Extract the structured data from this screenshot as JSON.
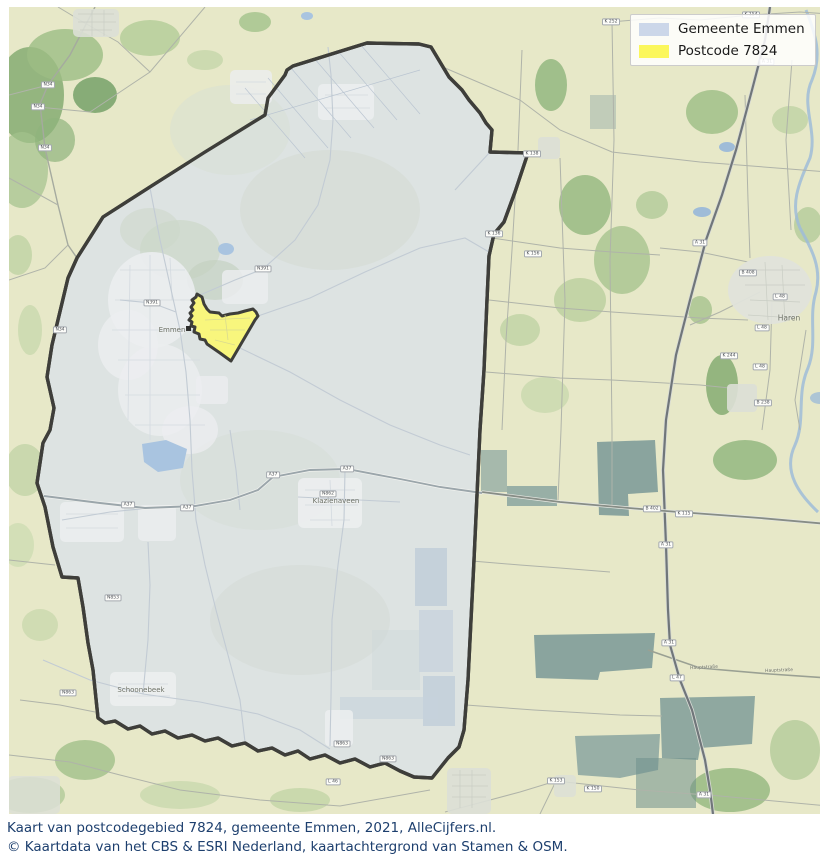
{
  "legend": {
    "items": [
      {
        "label": "Gemeente Emmen",
        "swatch_color": "#ccd7e9"
      },
      {
        "label": "Postcode 7824",
        "swatch_color": "#fbf75c"
      }
    ]
  },
  "caption": {
    "lines": [
      "Kaart van postcodegebied 7824, gemeente Emmen, 2021, AlleCijfers.nl.",
      "© Kaartdata van het CBS & ESRI Nederland, kaartachtergrond van Stamen & OSM."
    ],
    "text_color": "#1d3f6e"
  },
  "map": {
    "region_name": "Gemeente Emmen",
    "highlight_name": "Postcode 7824",
    "colors": {
      "municipality_fill": "#dde3e2",
      "municipality_border": "#3e3e3a",
      "highlight_fill": "#f8f67d",
      "background_land": "#e7e8c8",
      "water": "#a9c4e0"
    },
    "town_labels": [
      {
        "text": "Emmen",
        "x": 172,
        "y": 330,
        "size": 7
      },
      {
        "text": "Klazienaveen",
        "x": 336,
        "y": 501,
        "size": 7
      },
      {
        "text": "Schoonebeek",
        "x": 141,
        "y": 690,
        "size": 7
      },
      {
        "text": "Haren",
        "x": 789,
        "y": 318,
        "size": 7.5
      },
      {
        "text": "Hauptstraße",
        "x": 704,
        "y": 668,
        "size": 4.5,
        "rot": -3
      },
      {
        "text": "Hauptstraße",
        "x": 779,
        "y": 671,
        "size": 4.5,
        "rot": -2
      }
    ],
    "road_badges": [
      {
        "label": "N34",
        "x": 48,
        "y": 85
      },
      {
        "label": "N34",
        "x": 38,
        "y": 107
      },
      {
        "label": "N34",
        "x": 45,
        "y": 148
      },
      {
        "label": "N34",
        "x": 60,
        "y": 330
      },
      {
        "label": "A37",
        "x": 128,
        "y": 505
      },
      {
        "label": "A37",
        "x": 187,
        "y": 508
      },
      {
        "label": "A37",
        "x": 273,
        "y": 475
      },
      {
        "label": "A37",
        "x": 347,
        "y": 469
      },
      {
        "label": "N862",
        "x": 328,
        "y": 494
      },
      {
        "label": "N391",
        "x": 152,
        "y": 303
      },
      {
        "label": "N391",
        "x": 263,
        "y": 269
      },
      {
        "label": "N853",
        "x": 113,
        "y": 598
      },
      {
        "label": "N863",
        "x": 68,
        "y": 693
      },
      {
        "label": "N863",
        "x": 342,
        "y": 744
      },
      {
        "label": "N863",
        "x": 388,
        "y": 759
      },
      {
        "label": "L 46",
        "x": 333,
        "y": 782
      },
      {
        "label": "B 402",
        "x": 652,
        "y": 509
      },
      {
        "label": "K 115",
        "x": 684,
        "y": 514
      },
      {
        "label": "K 156",
        "x": 533,
        "y": 254
      },
      {
        "label": "K 138",
        "x": 532,
        "y": 154
      },
      {
        "label": "K 136",
        "x": 494,
        "y": 234
      },
      {
        "label": "K 252",
        "x": 611,
        "y": 22
      },
      {
        "label": "K 154",
        "x": 751,
        "y": 15
      },
      {
        "label": "A 31",
        "x": 767,
        "y": 62
      },
      {
        "label": "A 31",
        "x": 700,
        "y": 243
      },
      {
        "label": "A 31",
        "x": 666,
        "y": 545
      },
      {
        "label": "A 31",
        "x": 669,
        "y": 643
      },
      {
        "label": "A 31",
        "x": 704,
        "y": 795
      },
      {
        "label": "L 47",
        "x": 677,
        "y": 678
      },
      {
        "label": "B 408",
        "x": 748,
        "y": 273
      },
      {
        "label": "L 48",
        "x": 780,
        "y": 297
      },
      {
        "label": "L 48",
        "x": 762,
        "y": 328
      },
      {
        "label": "L 48",
        "x": 760,
        "y": 367
      },
      {
        "label": "B 238",
        "x": 763,
        "y": 403
      },
      {
        "label": "K 244",
        "x": 729,
        "y": 356
      },
      {
        "label": "K 153",
        "x": 556,
        "y": 781
      },
      {
        "label": "K 150",
        "x": 593,
        "y": 789
      }
    ]
  }
}
